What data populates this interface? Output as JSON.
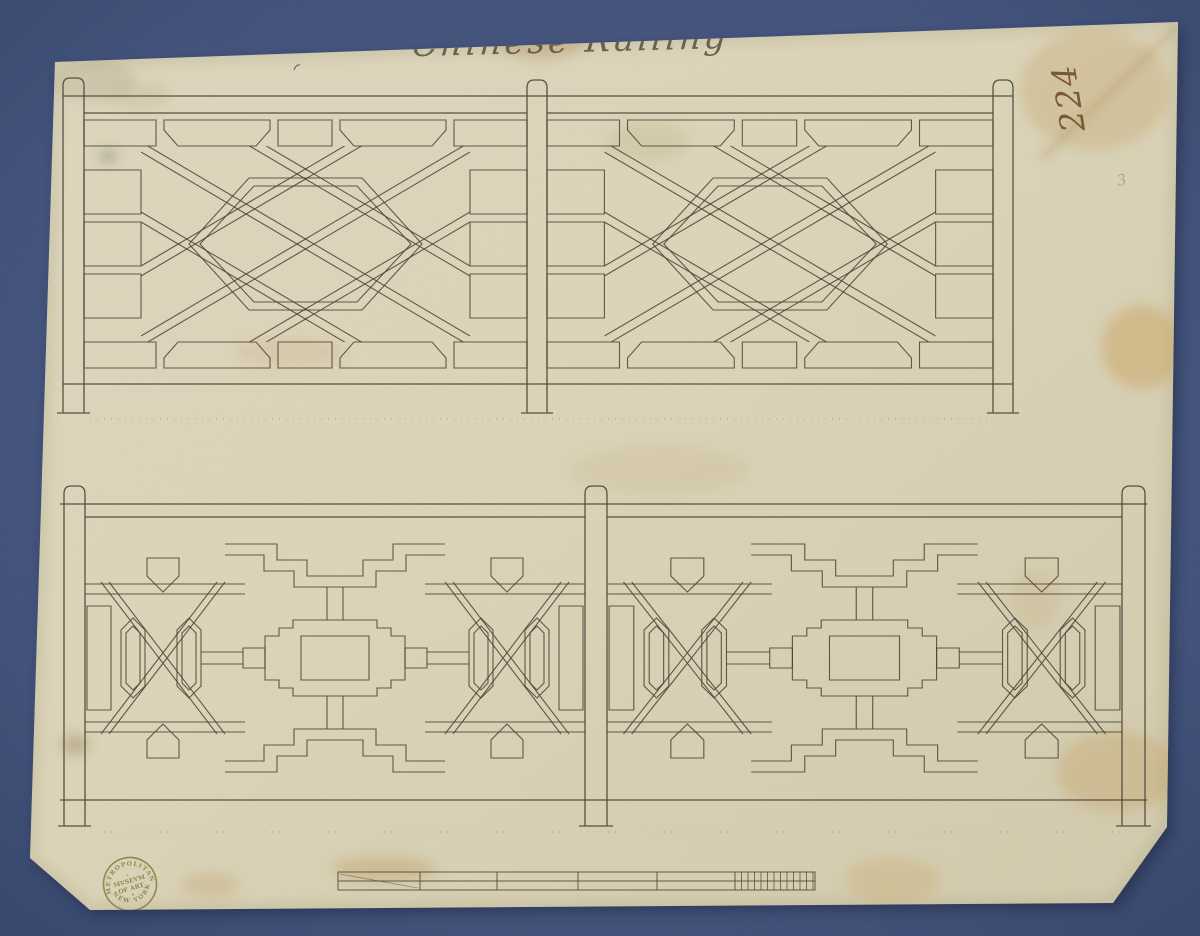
{
  "artwork": {
    "title_inscription": "Chinese Railing",
    "inventory_number": "224",
    "stamp": {
      "arc_top": "METROPOLITAN",
      "center_line_1": "MVSEVM",
      "center_line_2": "OF ART",
      "arc_bottom": "NEW YORK"
    }
  },
  "colors": {
    "background_mat": "#44547c",
    "paper": "#ddd6bc",
    "drawing_ink": "#4a4337",
    "inscription_ink": "#54483a",
    "number_ink": "#6f4e2a",
    "stamp_ink": "#8d7b42"
  }
}
